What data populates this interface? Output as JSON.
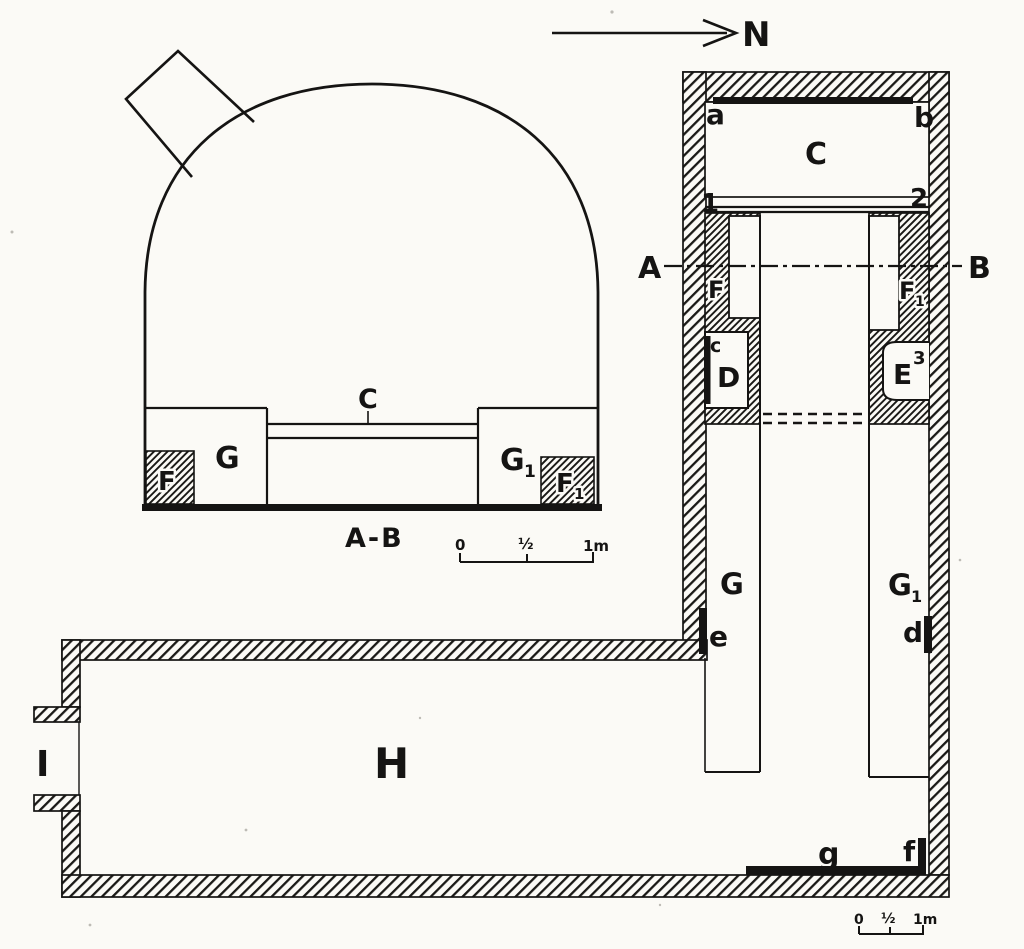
{
  "canvas": {
    "paper_color": "#fbfaf6",
    "ink_color": "#151413"
  },
  "north": {
    "label": "N"
  },
  "section": {
    "shelf_label": "C",
    "bench_left": "G",
    "bench_right": "G",
    "bench_right_sub": "1",
    "pit_left": "F",
    "pit_right": "F",
    "pit_right_sub": "1",
    "caption": "A-B",
    "scale": {
      "zero": "0",
      "half": "½",
      "one": "1m"
    }
  },
  "plan": {
    "corner_a": "a",
    "corner_b": "b",
    "room_c": "C",
    "mark_1": "1",
    "mark_2": "2",
    "section_line_left": "A",
    "section_line_right": "B",
    "block_left": "F",
    "block_right": "F",
    "block_right_sub": "1",
    "niche_c": "c",
    "niche_d": "D",
    "niche_e": "E",
    "niche_e_sup": "3",
    "corridor_left": "G",
    "corridor_right": "G",
    "corridor_right_sub": "1",
    "jamb_e": "e",
    "jamb_d": "d",
    "room_h": "H",
    "door_i": "I",
    "bench_g": "g",
    "jamb_f": "f",
    "scale": {
      "zero": "0",
      "half": "½",
      "one": "1m"
    }
  }
}
